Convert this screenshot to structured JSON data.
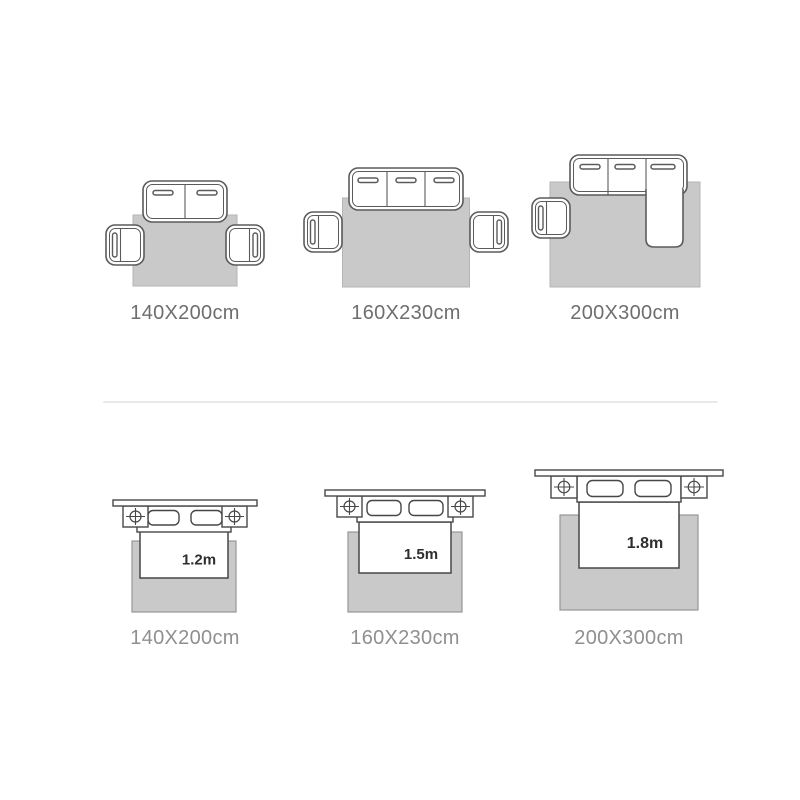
{
  "page": {
    "background": "#ffffff"
  },
  "colors": {
    "rug_fill": "#c9c9c9",
    "sofa_outline": "#5b5b5b",
    "bed_outline": "#474747",
    "top_label_color": "#6e6e6e",
    "bottom_label_color": "#8f8f8f",
    "bed_size_text_color": "#2e2e2e",
    "divider": "#e9e9e9"
  },
  "sofa_section": {
    "items": [
      {
        "label": "140X200cm",
        "furniture": "two-seat-sofa-with-two-armchairs"
      },
      {
        "label": "160X230cm",
        "furniture": "three-seat-sofa-with-two-armchairs"
      },
      {
        "label": "200X300cm",
        "furniture": "corner-sofa-with-armchair"
      }
    ]
  },
  "bed_section": {
    "items": [
      {
        "bed_size": "1.2m",
        "label": "140X200cm"
      },
      {
        "bed_size": "1.5m",
        "label": "160X230cm"
      },
      {
        "bed_size": "1.8m",
        "label": "200X300cm"
      }
    ]
  }
}
